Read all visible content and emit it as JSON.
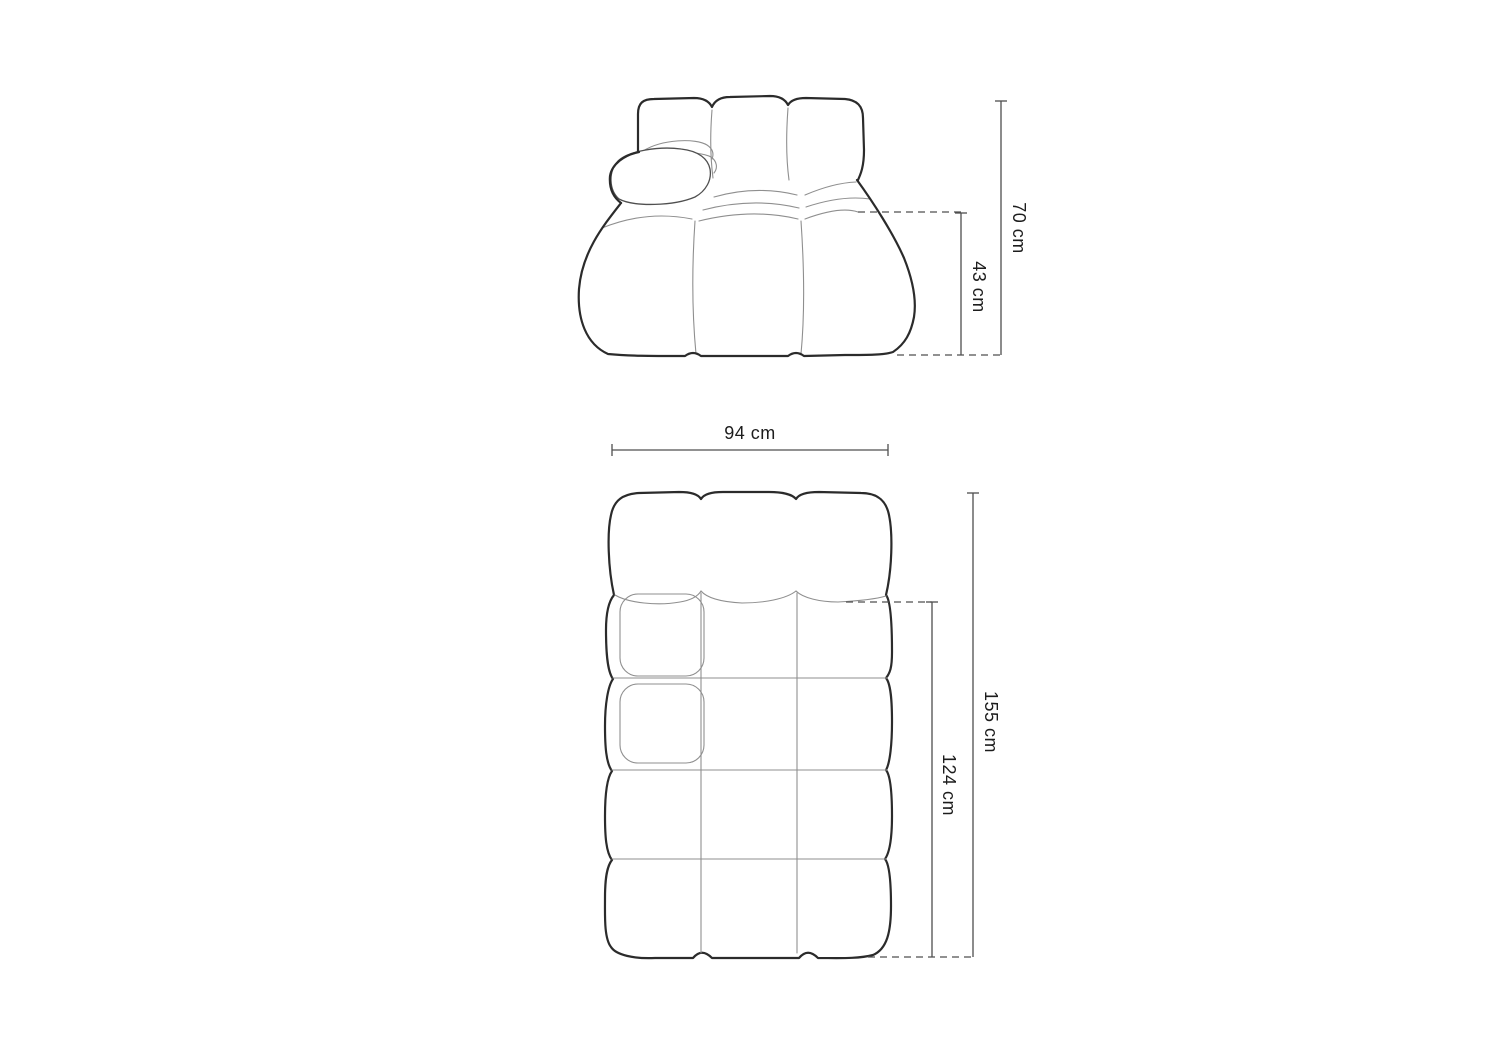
{
  "diagram": {
    "front_view": {
      "height_label": "70 cm",
      "seat_height_label": "43 cm"
    },
    "top_view": {
      "width_label": "94 cm",
      "length_label": "155 cm",
      "inner_length_label": "124 cm"
    },
    "colors": {
      "background": "#ffffff",
      "outline": "#2b2b2b",
      "detail_line": "#8f8f8f",
      "dimension_line": "#4f4f4f",
      "text": "#1d1d1d"
    }
  }
}
